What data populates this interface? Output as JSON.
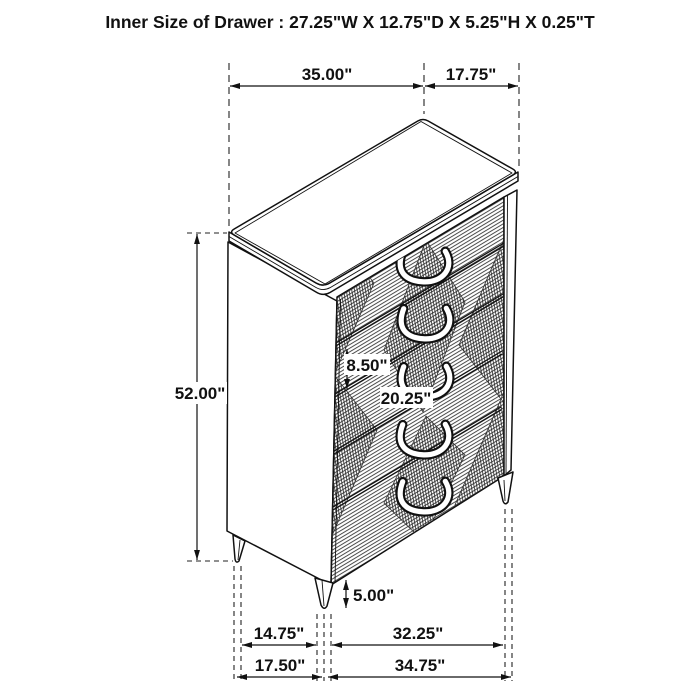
{
  "title": "Inner Size of Drawer : 27.25\"W X 12.75\"D X 5.25\"H X 0.25\"T",
  "subject": "5-drawer chest isometric dimension drawing",
  "drawer_count": 5,
  "colors": {
    "line": "#111111",
    "background": "#ffffff"
  },
  "dim_labels": {
    "top_width": "35.00\"",
    "top_depth": "17.75\"",
    "overall_height": "52.00\"",
    "drawer_front_height": "8.50\"",
    "drawer_front_width": "20.25\"",
    "leg_height": "5.00\"",
    "base_side_to_leg": "14.75\"",
    "base_leg_to_leg": "32.25\"",
    "base_depth": "17.50\"",
    "base_width": "34.75\""
  }
}
